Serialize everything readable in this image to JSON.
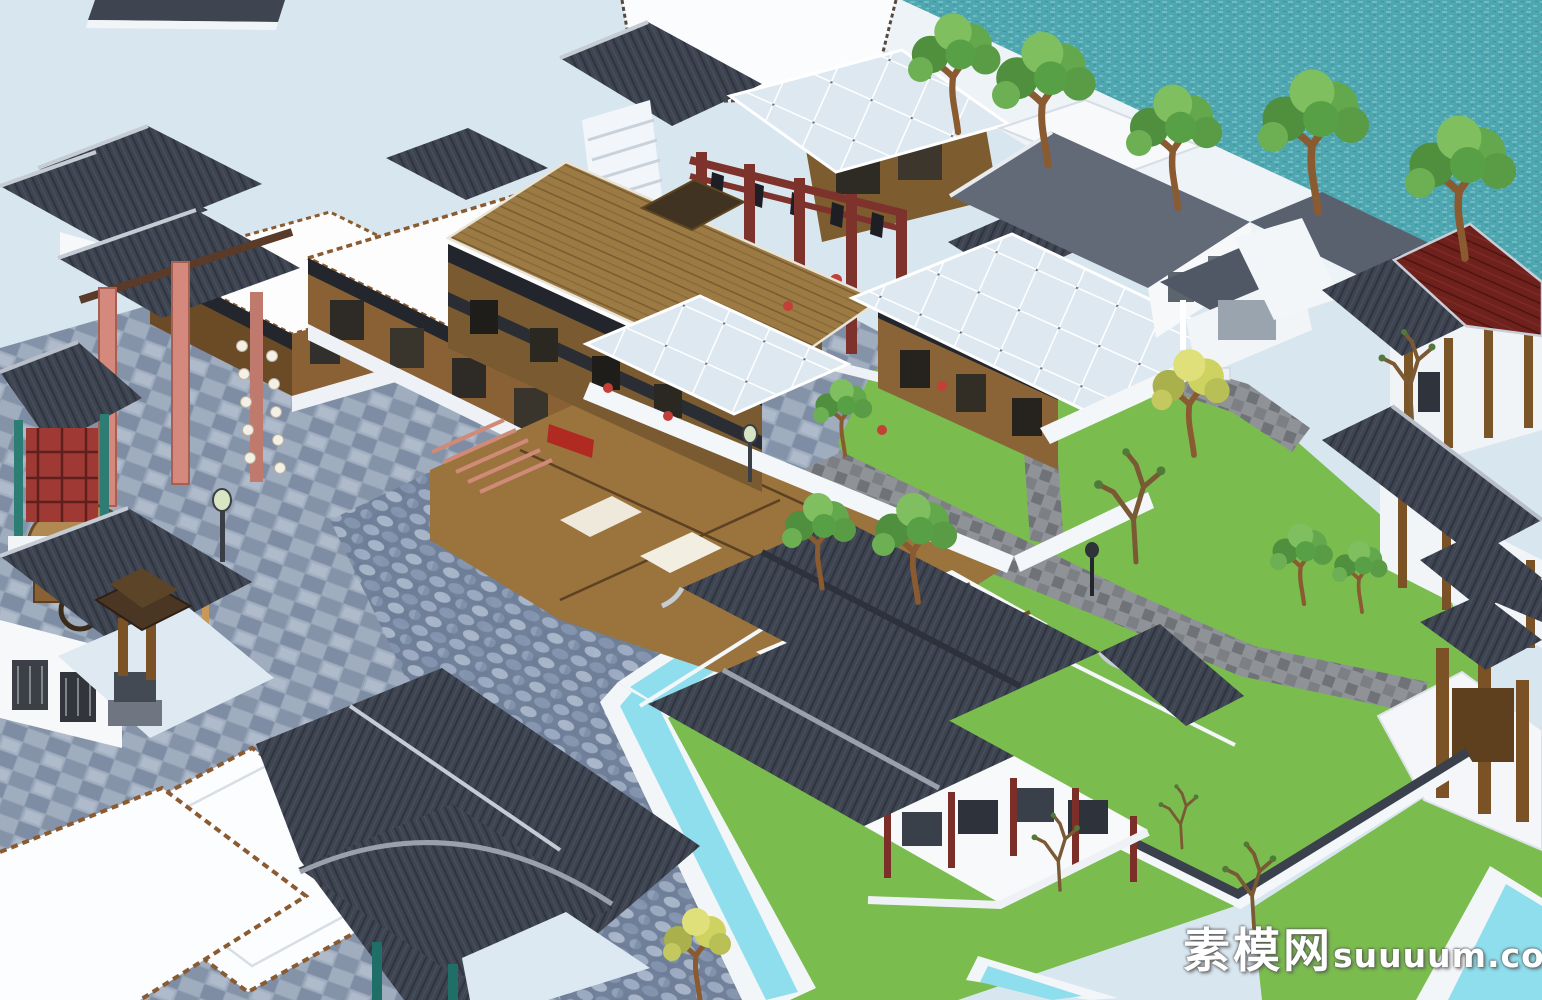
{
  "watermark": {
    "cn": "素模网",
    "en": "suuuum.com"
  },
  "palette": {
    "lake": "#d8e6ef",
    "sea": "#4da6b0",
    "sea_light": "#7ac2c9",
    "promenade": "#eef3f8",
    "plaza": "#93a1b5",
    "cobble": "#70809b",
    "lawn": "#7abc4e",
    "path": "#8f9296",
    "channel_water": "#8edeed",
    "coping": "#f3f6f9",
    "roof_dark": "#3e4450",
    "roof_ridge": "#c6ccd4",
    "roof_brown": "#9c7a44",
    "roof_red": "#6e211d",
    "wood": "#8a6134",
    "wood_dark": "#6b4a26",
    "wall_white": "#f7f9fb",
    "maroon_timber": "#7d332c",
    "pink_pillar": "#d4897c",
    "teal_post": "#2e7d74",
    "lantern_red": "#c24038",
    "tree_green": "#63a84c",
    "tree_yellow": "#cdd261",
    "trunk": "#8a5a30"
  },
  "scene": {
    "description": "Aerial SketchUp-style render of a traditional Chinese ancient-town model: lake and teal river with waterfront trees, stone plaza with torii gate and lantern strings, cutaway timber shop complex with brown plank roof and glass canopies, red open pavilion, white courtyard houses on lawns with stone paths, tiled-roof garden pavilion ringed by water channels and tile-capped walls.",
    "elements": [
      "lake-water",
      "river-water",
      "waterfront-promenade",
      "stone-plaza",
      "cobble-paving",
      "lawn-courtyard",
      "stone-paths",
      "water-channels",
      "brown-plank-roof-complex",
      "glass-canopies",
      "red-timber-pavilion",
      "white-courtyard-building",
      "red-roof-corridor",
      "garden-pavilion",
      "tile-capped-garden-wall",
      "roof-terraces",
      "torii-gate",
      "lantern-strings",
      "rickshaw-cart",
      "dog",
      "shrine",
      "stone-lanterns",
      "street-lamps",
      "trees",
      "watermark"
    ]
  }
}
